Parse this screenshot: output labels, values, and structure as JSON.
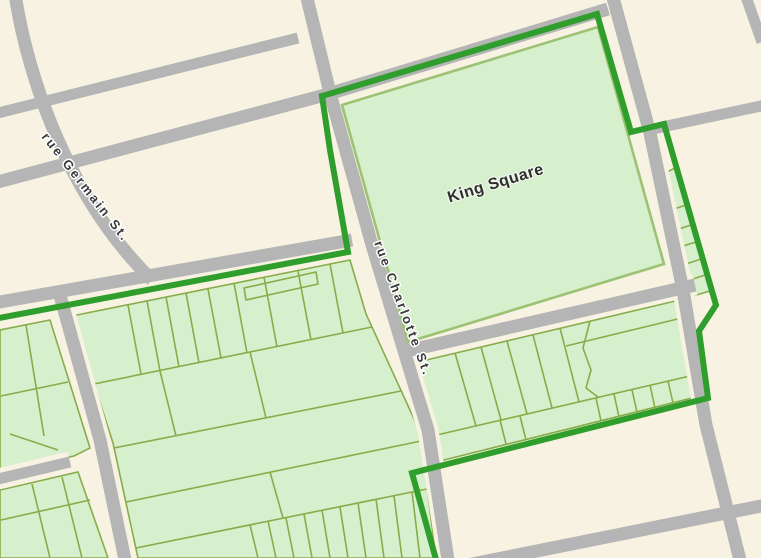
{
  "map": {
    "labels": {
      "park": "King Square",
      "street_germain": "rue Germain St.",
      "street_charlotte": "rue Charlotte St."
    },
    "colors": {
      "background": "#f7f2e1",
      "street_gray": "#b5b5b5",
      "parcel_fill": "#d6f0cd",
      "parcel_outline": "#87ac49",
      "park_fill": "#d6f0cd",
      "park_outline": "#9cc274",
      "boundary_green": "#2f9e2c",
      "label_text": "#3a3a3a"
    }
  }
}
